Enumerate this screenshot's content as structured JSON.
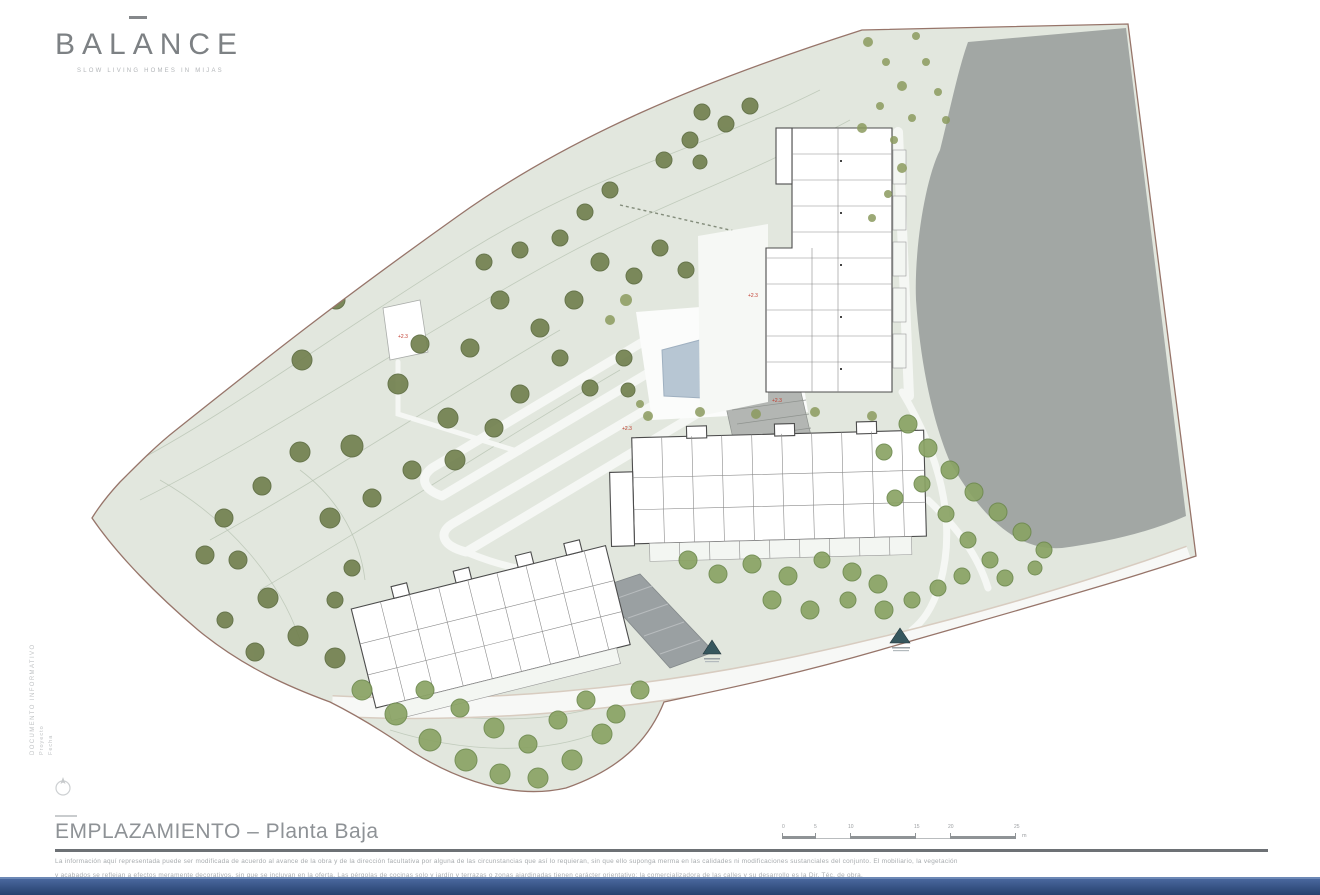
{
  "logo": {
    "text": "BALANCE",
    "tagline": "SLOW LIVING HOMES IN MIJAS"
  },
  "side_block": {
    "line1": "DOCUMENTO INFORMATIVO",
    "line2": "Proyecto",
    "line3": "Fecha"
  },
  "title_block": {
    "title": "EMPLAZAMIENTO – Planta Baja",
    "disclaimer_line1": "La información aquí representada puede ser modificada de acuerdo al avance de la obra y de la dirección facultativa por alguna de las circunstancias que así lo requieran, sin que ello suponga merma en las calidades ni modificaciones sustanciales del conjunto. El mobiliario, la vegetación",
    "disclaimer_line2": "y acabados se reflejan a efectos meramente decorativos, sin que se incluyan en la oferta. Las pérgolas de cocinas solo y jardín y terrazas o zonas ajardinadas tienen carácter orientativo; la comercializadora de las calles y su desarrollo es la Dir. Téc. de obra."
  },
  "scale_bar": {
    "ticks": [
      "0",
      "5",
      "10",
      "15",
      "20",
      "25"
    ],
    "unit": "m"
  },
  "plan": {
    "colors": {
      "terrain": "#e2e7de",
      "boundary": "#97756a",
      "slope": "#a2a7a4",
      "pool": "#b7c6d3",
      "bottom_bar": "#2c4876"
    },
    "spot_labels": [
      {
        "text": "+2.3"
      },
      {
        "text": "+2.3"
      },
      {
        "text": "+2.3"
      },
      {
        "text": "+2.3"
      }
    ],
    "trees": [
      [
        268,
        332,
        11,
        0
      ],
      [
        302,
        360,
        10,
        0
      ],
      [
        336,
        300,
        9,
        0
      ],
      [
        352,
        446,
        11,
        0
      ],
      [
        398,
        384,
        10,
        0
      ],
      [
        420,
        344,
        9,
        0
      ],
      [
        448,
        418,
        10,
        0
      ],
      [
        300,
        452,
        10,
        0
      ],
      [
        262,
        486,
        9,
        0
      ],
      [
        224,
        518,
        9,
        0
      ],
      [
        330,
        518,
        10,
        0
      ],
      [
        372,
        498,
        9,
        0
      ],
      [
        412,
        470,
        9,
        0
      ],
      [
        455,
        460,
        10,
        0
      ],
      [
        494,
        428,
        9,
        0
      ],
      [
        520,
        394,
        9,
        0
      ],
      [
        470,
        348,
        9,
        0
      ],
      [
        500,
        300,
        9,
        0
      ],
      [
        540,
        328,
        9,
        0
      ],
      [
        574,
        300,
        9,
        0
      ],
      [
        600,
        262,
        9,
        0
      ],
      [
        634,
        276,
        8,
        0
      ],
      [
        660,
        248,
        8,
        0
      ],
      [
        686,
        270,
        8,
        0
      ],
      [
        560,
        358,
        8,
        0
      ],
      [
        590,
        388,
        8,
        0
      ],
      [
        624,
        358,
        8,
        0
      ],
      [
        628,
        390,
        7,
        0
      ],
      [
        664,
        160,
        8,
        0
      ],
      [
        690,
        140,
        8,
        0
      ],
      [
        702,
        112,
        8,
        0
      ],
      [
        726,
        124,
        8,
        0
      ],
      [
        750,
        106,
        8,
        0
      ],
      [
        700,
        162,
        7,
        0
      ],
      [
        610,
        190,
        8,
        0
      ],
      [
        585,
        212,
        8,
        0
      ],
      [
        560,
        238,
        8,
        0
      ],
      [
        520,
        250,
        8,
        0
      ],
      [
        484,
        262,
        8,
        0
      ],
      [
        868,
        42,
        5,
        2
      ],
      [
        886,
        62,
        4,
        2
      ],
      [
        902,
        86,
        5,
        2
      ],
      [
        880,
        106,
        4,
        2
      ],
      [
        862,
        128,
        5,
        2
      ],
      [
        894,
        140,
        4,
        2
      ],
      [
        912,
        118,
        4,
        2
      ],
      [
        926,
        62,
        4,
        2
      ],
      [
        938,
        92,
        4,
        2
      ],
      [
        916,
        36,
        4,
        2
      ],
      [
        946,
        120,
        4,
        2
      ],
      [
        902,
        168,
        5,
        2
      ],
      [
        888,
        194,
        4,
        2
      ],
      [
        872,
        218,
        4,
        2
      ],
      [
        205,
        555,
        9,
        0
      ],
      [
        238,
        560,
        9,
        0
      ],
      [
        268,
        598,
        10,
        0
      ],
      [
        298,
        636,
        10,
        0
      ],
      [
        335,
        658,
        10,
        0
      ],
      [
        255,
        652,
        9,
        0
      ],
      [
        225,
        620,
        8,
        0
      ],
      [
        362,
        690,
        10,
        1
      ],
      [
        396,
        714,
        11,
        1
      ],
      [
        430,
        740,
        11,
        1
      ],
      [
        466,
        760,
        11,
        1
      ],
      [
        500,
        774,
        10,
        1
      ],
      [
        538,
        778,
        10,
        1
      ],
      [
        572,
        760,
        10,
        1
      ],
      [
        602,
        734,
        10,
        1
      ],
      [
        425,
        690,
        9,
        1
      ],
      [
        460,
        708,
        9,
        1
      ],
      [
        494,
        728,
        10,
        1
      ],
      [
        528,
        744,
        9,
        1
      ],
      [
        558,
        720,
        9,
        1
      ],
      [
        586,
        700,
        9,
        1
      ],
      [
        616,
        714,
        9,
        1
      ],
      [
        640,
        690,
        9,
        1
      ],
      [
        352,
        568,
        8,
        0
      ],
      [
        335,
        600,
        8,
        0
      ],
      [
        688,
        560,
        9,
        1
      ],
      [
        718,
        574,
        9,
        1
      ],
      [
        752,
        564,
        9,
        1
      ],
      [
        788,
        576,
        9,
        1
      ],
      [
        822,
        560,
        8,
        1
      ],
      [
        852,
        572,
        9,
        1
      ],
      [
        878,
        584,
        9,
        1
      ],
      [
        772,
        600,
        9,
        1
      ],
      [
        810,
        610,
        9,
        1
      ],
      [
        848,
        600,
        8,
        1
      ],
      [
        884,
        610,
        9,
        1
      ],
      [
        912,
        600,
        8,
        1
      ],
      [
        938,
        588,
        8,
        1
      ],
      [
        962,
        576,
        8,
        1
      ],
      [
        908,
        424,
        9,
        1
      ],
      [
        928,
        448,
        9,
        1
      ],
      [
        950,
        470,
        9,
        1
      ],
      [
        974,
        492,
        9,
        1
      ],
      [
        998,
        512,
        9,
        1
      ],
      [
        1022,
        532,
        9,
        1
      ],
      [
        1044,
        550,
        8,
        1
      ],
      [
        922,
        484,
        8,
        1
      ],
      [
        946,
        514,
        8,
        1
      ],
      [
        968,
        540,
        8,
        1
      ],
      [
        990,
        560,
        8,
        1
      ],
      [
        884,
        452,
        8,
        1
      ],
      [
        895,
        498,
        8,
        1
      ],
      [
        1005,
        578,
        8,
        1
      ],
      [
        1035,
        568,
        7,
        1
      ],
      [
        648,
        416,
        5,
        2
      ],
      [
        700,
        412,
        5,
        2
      ],
      [
        756,
        414,
        5,
        2
      ],
      [
        815,
        412,
        5,
        2
      ],
      [
        872,
        416,
        5,
        2
      ],
      [
        640,
        404,
        4,
        2
      ],
      [
        626,
        300,
        6,
        2
      ],
      [
        610,
        320,
        5,
        2
      ]
    ]
  }
}
